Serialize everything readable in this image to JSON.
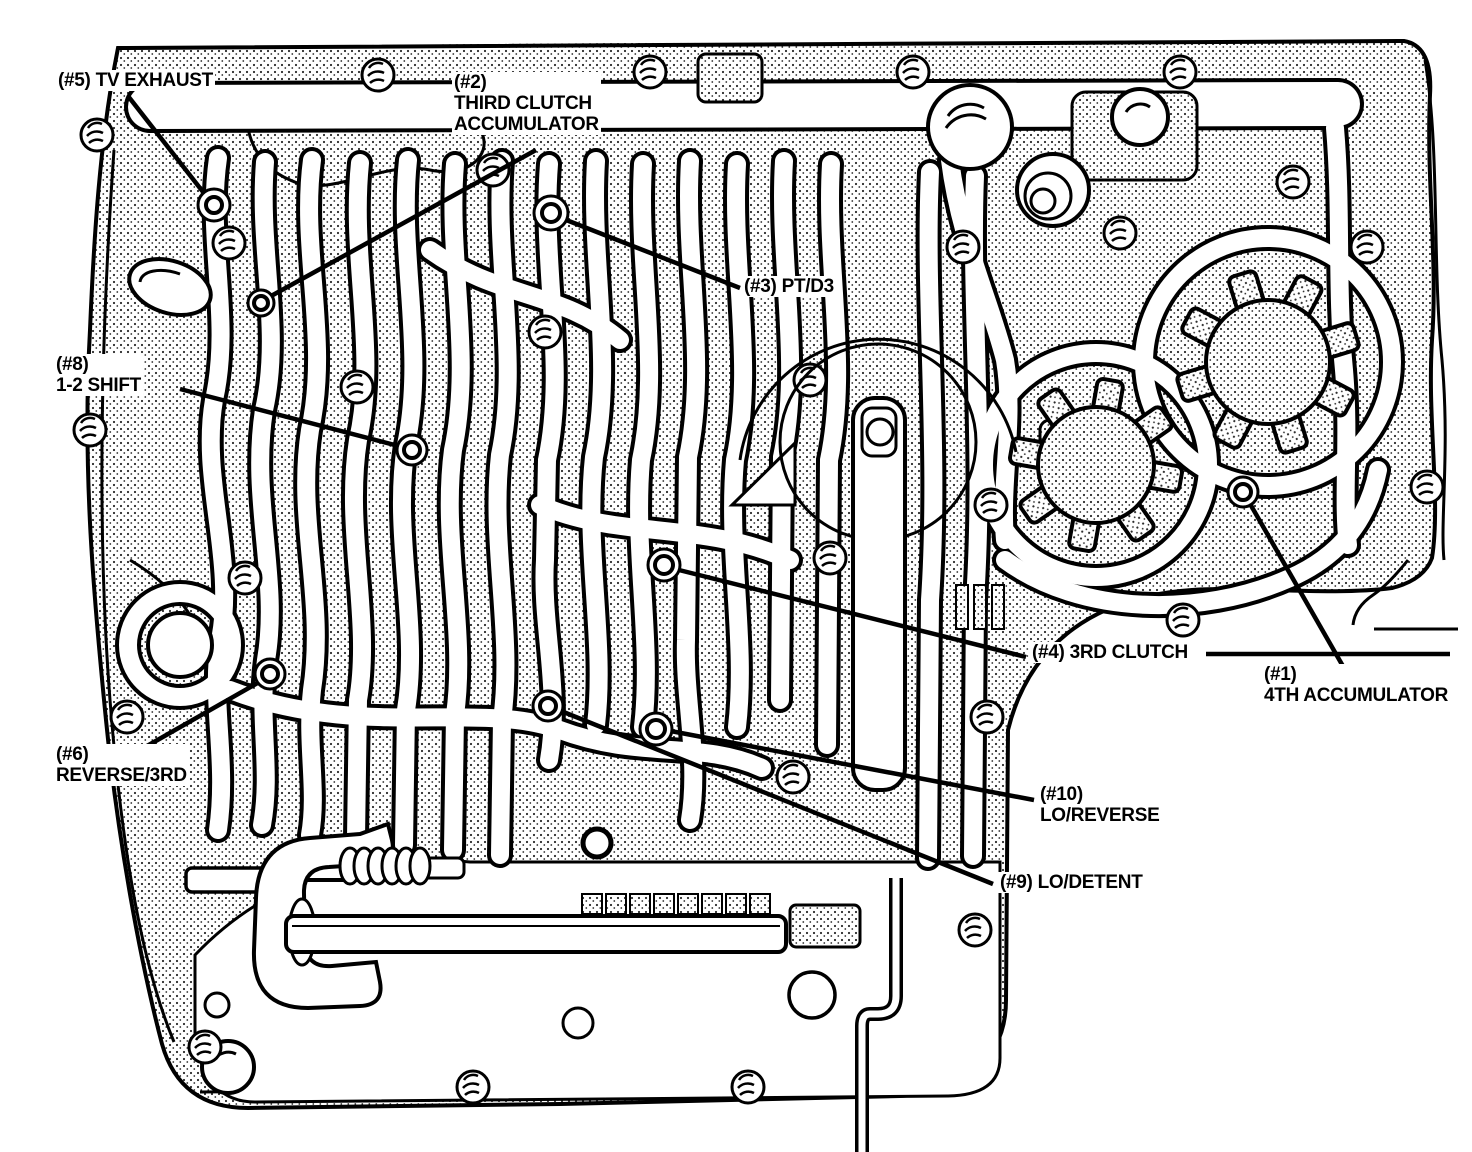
{
  "diagram": {
    "kind": "transmission-case-valve-body-check-ball-locations",
    "colors": {
      "ink": "#000000",
      "paper": "#ffffff"
    }
  },
  "callouts": [
    {
      "id": "1",
      "lines": [
        "(#1)",
        "4TH ACCUMULATOR"
      ]
    },
    {
      "id": "2",
      "lines": [
        "(#2)",
        "THIRD CLUTCH",
        "ACCUMULATOR"
      ]
    },
    {
      "id": "3",
      "lines": [
        "(#3) PT/D3"
      ]
    },
    {
      "id": "4",
      "lines": [
        "(#4) 3RD CLUTCH"
      ]
    },
    {
      "id": "5",
      "lines": [
        "(#5) TV EXHAUST"
      ]
    },
    {
      "id": "6",
      "lines": [
        "(#6)",
        "REVERSE/3RD"
      ]
    },
    {
      "id": "8",
      "lines": [
        "(#8)",
        "1-2 SHIFT"
      ]
    },
    {
      "id": "9",
      "lines": [
        "(#9) LO/DETENT"
      ]
    },
    {
      "id": "10",
      "lines": [
        "(#10)",
        "LO/REVERSE"
      ]
    }
  ]
}
